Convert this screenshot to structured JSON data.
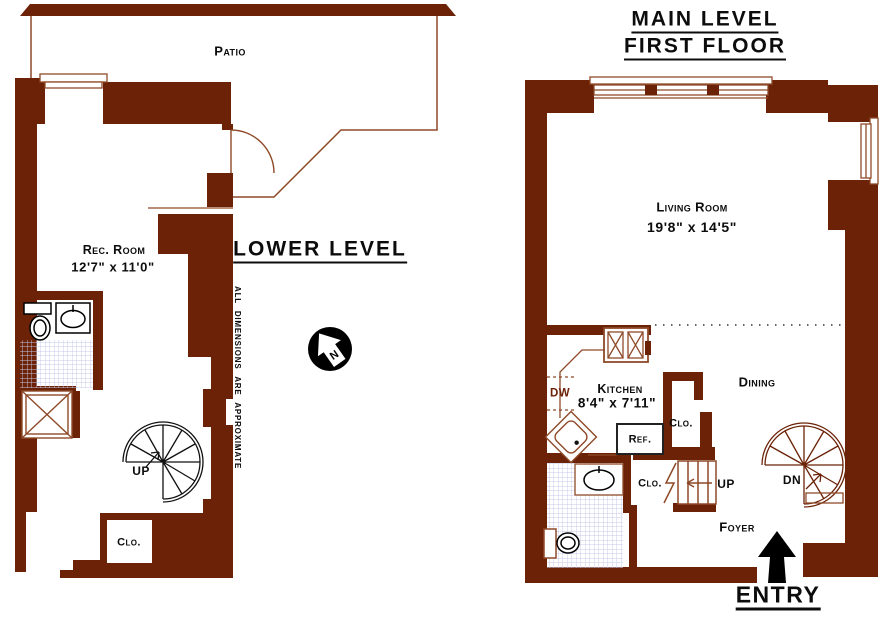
{
  "palette": {
    "wall": "#6b2206",
    "thin_line": "#8e4a28",
    "text": "#111111",
    "tile_line": "#c4c9ea",
    "fixture_black": "#000000"
  },
  "lower_level": {
    "title": "LOWER LEVEL",
    "patio_label": "Patio",
    "rec_room_name": "Rec. Room",
    "rec_room_dims": "12'7\" x 11'0\"",
    "stair_label": "UP",
    "closet_label": "Clo.",
    "disclaimer": "ALL DIMENSIONS ARE APPROXIMATE",
    "compass_north": "N"
  },
  "main_level": {
    "title_line1": "MAIN LEVEL",
    "title_line2": "FIRST FLOOR",
    "living_room_name": "Living Room",
    "living_room_dims": "19'8\" x 14'5\"",
    "kitchen_name": "Kitchen",
    "kitchen_dims": "8'4\" x 7'11\"",
    "dishwasher_label": "DW",
    "refrigerator_label": "Ref.",
    "kitchen_closet_label": "Clo.",
    "stair_closet_label": "Clo.",
    "stair_up_label": "UP",
    "stair_down_label": "DN",
    "dining_label": "Dining",
    "foyer_label": "Foyer",
    "entry_label": "ENTRY"
  }
}
